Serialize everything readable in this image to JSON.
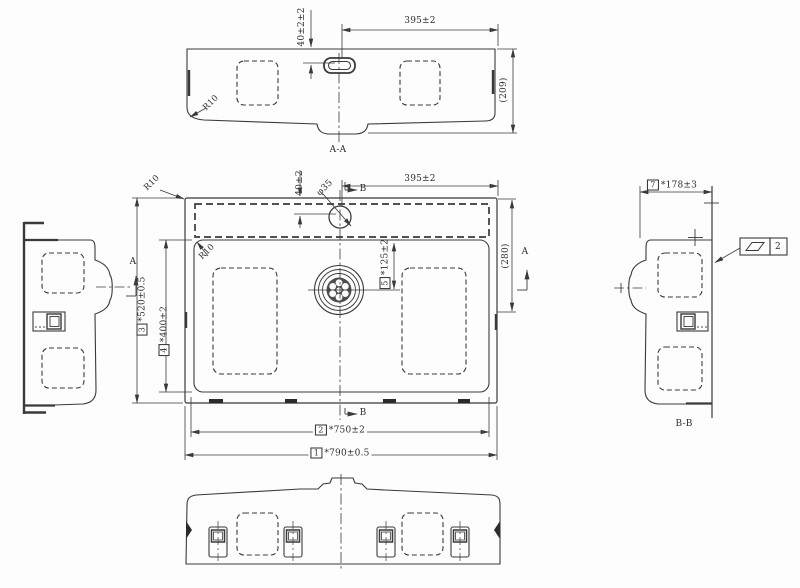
{
  "drawing": {
    "views": {
      "section_aa": {
        "label": "A-A",
        "dims": {
          "hole_offset": "40±2±2",
          "hole_span": "395±2",
          "height": "(209)",
          "corner_radius": "R10"
        }
      },
      "plan": {
        "dims": {
          "hole_offset": "40±2",
          "hole_diameter": "φ35",
          "hole_span": "395±2",
          "back_depth": "(280)",
          "corner_radius_outer": "R10",
          "corner_radius_inner": "R10",
          "drain_offset": {
            "no": "5",
            "value": "*125±2"
          },
          "overall_depth": {
            "no": "3",
            "value": "*520±0.5"
          },
          "bowl_depth": {
            "no": "4",
            "value": "*400±2"
          },
          "bowl_width": {
            "no": "2",
            "value": "*750±2"
          },
          "overall_width": {
            "no": "1",
            "value": "*790±0.5"
          }
        },
        "section_marks": {
          "a": "A",
          "b": "B"
        }
      },
      "section_bb": {
        "label": "B-B",
        "dims": {
          "depth": {
            "no": "7",
            "value": "*178±3"
          }
        },
        "gdt": {
          "symbol": "flatness-parallelogram",
          "value": "2"
        }
      }
    },
    "line_color": "#3a3a3a"
  }
}
